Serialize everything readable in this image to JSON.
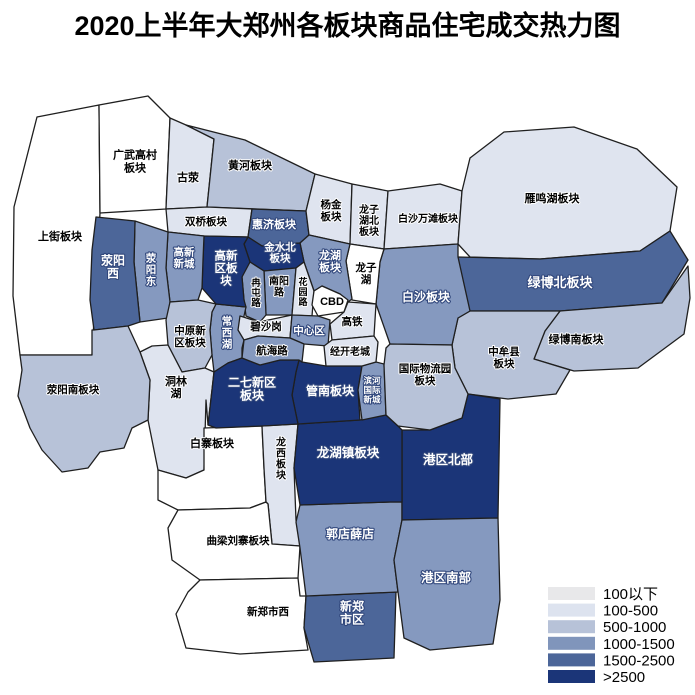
{
  "title": "2020上半年大郑州各板块商品住宅成交热力图",
  "legend": {
    "x": 548,
    "y": 587,
    "swatch_w": 47,
    "swatch_h": 13,
    "row_h": 16.6,
    "label_gap": 8,
    "items": [
      {
        "label": "100以下",
        "color": "#e8e8ea"
      },
      {
        "label": "100-500",
        "color": "#dde3ef"
      },
      {
        "label": "500-1000",
        "color": "#b7c2d8"
      },
      {
        "label": "1000-1500",
        "color": "#8095bb"
      },
      {
        "label": "1500-2500",
        "color": "#4c6699"
      },
      {
        "label": ">2500",
        "color": "#1b3578"
      }
    ]
  },
  "map": {
    "border_color": "#1f1f1f",
    "tier_fills": [
      "#ffffff",
      "#dfe4ef",
      "#b7c2d8",
      "#8599bf",
      "#4c6699",
      "#1b3578"
    ],
    "regions": [
      {
        "id": "shangjie",
        "label": "上街板块",
        "tier": 1,
        "range": "100以下",
        "c": "d",
        "x": 60,
        "y": 237,
        "fs": 11,
        "pts": "37,117 99,105 100,213 92,355 20,355 13,296 14,207"
      },
      {
        "id": "guangwu-gaocun",
        "label": "广武高村板块",
        "lines": [
          "广武高村",
          "板块"
        ],
        "tier": 1,
        "range": "100以下",
        "c": "d",
        "x": 135,
        "y": 162,
        "fs": 11,
        "lh": 13,
        "pts": "99,105 148,96 170,118 166,209 100,213"
      },
      {
        "id": "guying",
        "label": "古荥",
        "tier": 2,
        "range": "100-500",
        "c": "d",
        "x": 188,
        "y": 178,
        "fs": 11,
        "pts": "170,118 186,125 214,139 207,207 166,209"
      },
      {
        "id": "huanghe",
        "label": "黄河板块",
        "tier": 3,
        "range": "500-1000",
        "c": "d",
        "x": 250,
        "y": 166,
        "fs": 11,
        "pts": "186,125 245,140 315,174 306,211 207,207 214,139"
      },
      {
        "id": "shuangqiao",
        "label": "双桥板块",
        "tier": 2,
        "range": "100-500",
        "c": "d",
        "x": 206,
        "y": 222,
        "fs": 10.5,
        "pts": "166,209 207,207 252,209 248,237 204,236 168,232"
      },
      {
        "id": "huiji",
        "label": "惠济板块",
        "tier": 5,
        "range": "1500-2500",
        "c": "l",
        "x": 274,
        "y": 225,
        "fs": 11,
        "pts": "252,209 306,211 309,235 300,243 262,246 248,237"
      },
      {
        "id": "yangjin",
        "label": "杨金板块",
        "lines": [
          "杨金",
          "板块"
        ],
        "tier": 2,
        "range": "100-500",
        "c": "d",
        "x": 331,
        "y": 211,
        "fs": 10.5,
        "lh": 12,
        "pts": "306,211 315,174 352,184 350,244 309,235"
      },
      {
        "id": "longzihu-bei",
        "label": "龙子湖北板块",
        "lines": [
          "龙子",
          "湖北",
          "板块"
        ],
        "tier": 2,
        "range": "100-500",
        "c": "d",
        "x": 369,
        "y": 221,
        "fs": 10,
        "lh": 11,
        "pts": "352,184 388,191 384,249 350,244"
      },
      {
        "id": "baisha-wantan",
        "label": "白沙万滩板块",
        "tier": 2,
        "range": "100-500",
        "c": "d",
        "x": 428,
        "y": 219,
        "fs": 10,
        "pts": "388,191 440,184 462,191 458,244 384,249"
      },
      {
        "id": "yanminghu",
        "label": "雁鸣湖板块",
        "tier": 2,
        "range": "100-500",
        "c": "d",
        "x": 552,
        "y": 199,
        "fs": 11,
        "pts": "462,191 470,158 504,132 574,127 637,149 677,187 670,231 640,251 540,259 470,257 458,244"
      },
      {
        "id": "lvbo-bei",
        "label": "绿博北板块",
        "tier": 5,
        "range": "1500-2500",
        "c": "l",
        "x": 560,
        "y": 282,
        "fs": 13,
        "pts": "458,257 540,259 640,251 670,231 688,260 662,303 560,311 470,311 458,295"
      },
      {
        "id": "lvbo-nan",
        "label": "绿博南板块",
        "tier": 3,
        "range": "500-1000",
        "c": "d",
        "x": 576,
        "y": 340,
        "fs": 11,
        "pts": "560,311 662,303 688,266 690,298 684,334 638,368 574,371 534,359 545,331"
      },
      {
        "id": "zhongmou",
        "label": "中牟县板块",
        "lines": [
          "中牟县",
          "板块"
        ],
        "tier": 3,
        "range": "500-1000",
        "c": "d",
        "x": 504,
        "y": 358,
        "fs": 10.5,
        "lh": 12,
        "pts": "458,318 470,311 560,311 545,331 534,359 570,370 556,394 508,399 468,394 455,368 452,345"
      },
      {
        "id": "baisha",
        "label": "白沙板块",
        "tier": 4,
        "range": "1000-1500",
        "c": "l",
        "x": 426,
        "y": 297,
        "fs": 12,
        "pts": "384,249 458,244 458,257 470,311 458,318 452,345 390,344 376,304 380,262"
      },
      {
        "id": "longzihu",
        "label": "龙子湖",
        "lines": [
          "龙子",
          "湖"
        ],
        "tier": 1,
        "range": "100以下",
        "c": "d",
        "x": 366,
        "y": 274,
        "fs": 10.5,
        "lh": 12,
        "pts": "350,244 384,249 380,262 376,304 352,300 346,261"
      },
      {
        "id": "longhu",
        "label": "龙湖板块",
        "lines": [
          "龙湖",
          "板块"
        ],
        "tier": 4,
        "range": "1000-1500",
        "c": "l",
        "x": 330,
        "y": 262,
        "fs": 11,
        "lh": 12,
        "pts": "309,235 350,244 346,261 352,299 348,302 340,294 322,286 314,291 304,262 300,243"
      },
      {
        "id": "jinshui-bei",
        "label": "金水北板块",
        "lines": [
          "金水北",
          "板块"
        ],
        "tier": 6,
        "range": ">2500",
        "c": "l",
        "x": 280,
        "y": 253,
        "fs": 10.5,
        "lh": 11,
        "pts": "248,237 262,246 300,243 304,262 296,268 264,271 250,262 244,244"
      },
      {
        "id": "nanyang-lu",
        "label": "南阳路",
        "lines": [
          "南阳",
          "路"
        ],
        "tier": 4,
        "range": "1000-1500",
        "c": "d",
        "x": 279,
        "y": 287,
        "fs": 10,
        "lh": 11,
        "pts": "264,271 296,268 292,315 266,315"
      },
      {
        "id": "rantun-lu",
        "label": "冉屯路",
        "lines": [
          "冉",
          "屯",
          "路"
        ],
        "tier": 4,
        "range": "1000-1500",
        "c": "d",
        "x": 256,
        "y": 293,
        "fs": 9.5,
        "lh": 10,
        "pts": "250,262 264,271 266,315 260,322 246,316 244,300 242,277 244,268"
      },
      {
        "id": "huayuan-lu",
        "label": "花园路",
        "lines": [
          "花",
          "园",
          "路"
        ],
        "tier": 2,
        "range": "100-500",
        "c": "d",
        "x": 303,
        "y": 292,
        "fs": 9,
        "lh": 10,
        "pts": "296,268 304,262 314,291 312,316 292,315"
      },
      {
        "id": "cbd",
        "label": "CBD",
        "tier": 1,
        "range": "100以下",
        "c": "d",
        "x": 332,
        "y": 302,
        "fs": 11,
        "pts": "314,291 322,286 340,294 348,300 344,312 318,316 312,305"
      },
      {
        "id": "changxihu",
        "label": "常西湖",
        "lines": [
          "常",
          "西",
          "湖"
        ],
        "tier": 4,
        "range": "1000-1500",
        "c": "l",
        "x": 227,
        "y": 333,
        "fs": 10.5,
        "lh": 11.5,
        "pts": "216,304 246,307 244,316 244,340 242,348 242,358 228,363 214,372 212,355 210,330 212,312"
      },
      {
        "id": "gaoxin-qu",
        "label": "高新区板块",
        "lines": [
          "高新",
          "区板",
          "块"
        ],
        "tier": 6,
        "range": ">2500",
        "c": "l",
        "x": 226,
        "y": 269,
        "fs": 11.5,
        "lh": 12.5,
        "pts": "204,236 248,237 244,244 250,262 242,277 244,300 246,307 216,304 202,288 203,260"
      },
      {
        "id": "gaoxin-xincheng",
        "label": "高新新城",
        "lines": [
          "高新",
          "新城"
        ],
        "tier": 4,
        "range": "1000-1500",
        "c": "l",
        "x": 184,
        "y": 258,
        "fs": 10.5,
        "lh": 11.5,
        "pts": "168,232 204,236 203,260 202,288 198,300 170,302 166,268"
      },
      {
        "id": "xingyang-dong",
        "label": "荥阳东",
        "lines": [
          "荥",
          "阳",
          "东"
        ],
        "tier": 4,
        "range": "1000-1500",
        "c": "l",
        "x": 151,
        "y": 270,
        "fs": 10.5,
        "lh": 11.5,
        "pts": "135,221 168,232 166,268 170,302 168,318 140,322 134,262"
      },
      {
        "id": "xingyang-xi",
        "label": "荥阳西",
        "lines": [
          "荥阳",
          "西"
        ],
        "tier": 5,
        "range": "1500-2500",
        "c": "l",
        "x": 113,
        "y": 267,
        "fs": 12,
        "lh": 13,
        "pts": "96,217 135,221 134,262 140,322 128,326 94,330 90,300 92,250"
      },
      {
        "id": "zhongyuan-xinqu",
        "label": "中原新区板块",
        "lines": [
          "中原新",
          "区板块"
        ],
        "tier": 3,
        "range": "500-1000",
        "c": "d",
        "x": 190,
        "y": 337,
        "fs": 10.5,
        "lh": 12,
        "pts": "170,302 198,300 216,304 212,312 210,330 212,355 205,368 182,372 168,345 166,320"
      },
      {
        "id": "donglinhu",
        "label": "洞林湖",
        "lines": [
          "洞林",
          "湖"
        ],
        "tier": 2,
        "range": "100-500",
        "c": "d",
        "x": 176,
        "y": 388,
        "fs": 11,
        "lh": 12,
        "pts": "140,352 152,346 168,345 182,372 205,368 214,372 212,390 208,425 206,400 204,470 186,478 158,470 148,420 150,380"
      },
      {
        "id": "xingyang-nan",
        "label": "荥阳南板块",
        "tier": 3,
        "range": "500-1000",
        "c": "d",
        "x": 73,
        "y": 390,
        "fs": 10.5,
        "pts": "20,355 92,355 92,330 94,330 128,326 140,352 150,380 148,420 132,428 124,448 100,452 88,468 62,472 42,450 30,428 18,396 22,370"
      },
      {
        "id": "baizhai",
        "label": "白寨板块",
        "tier": 1,
        "range": "100以下",
        "c": "d",
        "x": 212,
        "y": 444,
        "fs": 11,
        "pts": "204,428 262,426 264,468 266,502 250,508 178,510 158,500 158,470 186,478 204,470"
      },
      {
        "id": "longxi",
        "label": "龙西板块",
        "lines": [
          "龙",
          "西",
          "板",
          "块"
        ],
        "tier": 2,
        "range": "100-500",
        "c": "d",
        "x": 281,
        "y": 459,
        "fs": 10,
        "lh": 11,
        "pts": "262,426 298,424 294,468 296,520 300,546 272,544 268,504 266,502 264,468"
      },
      {
        "id": "quliang-liuzhai",
        "label": "曲梁刘寨板块",
        "tier": 1,
        "range": "100以下",
        "c": "d",
        "x": 238,
        "y": 541,
        "fs": 10.5,
        "pts": "168,528 178,510 250,508 266,502 268,504 272,544 300,546 298,578 200,580 172,560"
      },
      {
        "id": "xinzheng-west",
        "label": "新郑市西",
        "tier": 1,
        "range": "100以下",
        "c": "d",
        "x": 268,
        "y": 612,
        "fs": 10.5,
        "pts": "200,580 298,578 300,596 306,596 304,628 308,650 240,654 186,648 176,614 188,592"
      },
      {
        "id": "xinzheng-city",
        "label": "新郑市区",
        "lines": [
          "新郑",
          "市区"
        ],
        "tier": 5,
        "range": "1500-2500",
        "c": "l",
        "x": 352,
        "y": 613,
        "fs": 12,
        "lh": 13,
        "pts": "306,596 396,592 394,658 314,662 304,628"
      },
      {
        "id": "guodian-xuedian",
        "label": "郭店薛店",
        "tier": 4,
        "range": "1000-1500",
        "c": "l",
        "x": 350,
        "y": 534,
        "fs": 12,
        "pts": "300,505 390,502 402,502 402,520 398,540 394,560 398,592 306,596 300,548 296,522"
      },
      {
        "id": "gangqu-bei",
        "label": "港区北部",
        "tier": 6,
        "range": ">2500",
        "c": "l",
        "x": 448,
        "y": 460,
        "fs": 12.5,
        "pts": "402,430 430,430 462,418 468,394 500,399 498,518 402,520"
      },
      {
        "id": "gangqu-nan",
        "label": "港区南部",
        "tier": 4,
        "range": "1000-1500",
        "c": "l",
        "x": 446,
        "y": 578,
        "fs": 12.5,
        "pts": "402,520 498,518 500,600 493,644 430,650 404,638 398,592 394,560 398,540"
      },
      {
        "id": "longhu-zhen",
        "label": "龙湖镇板块",
        "tier": 6,
        "range": ">2500",
        "c": "l",
        "x": 348,
        "y": 453,
        "fs": 12.5,
        "pts": "298,424 360,420 386,415 398,426 402,430 402,502 390,502 300,505 294,468"
      },
      {
        "id": "guannan",
        "label": "管南板块",
        "tier": 6,
        "range": ">2500",
        "c": "l",
        "x": 330,
        "y": 391,
        "fs": 12,
        "pts": "299,360 302,362 326,366 362,366 358,390 360,420 298,424 292,395 296,372"
      },
      {
        "id": "binhe",
        "label": "滨河国际新城",
        "lines": [
          "滨河",
          "国际",
          "新城"
        ],
        "tier": 4,
        "range": "1000-1500",
        "c": "l",
        "x": 372,
        "y": 390,
        "fs": 8.5,
        "lh": 9.5,
        "pts": "362,366 376,362 384,364 386,415 362,420 358,390"
      },
      {
        "id": "guoji-wuliu",
        "label": "国际物流园板块",
        "lines": [
          "国际物流园",
          "板块"
        ],
        "tier": 3,
        "range": "500-1000",
        "c": "d",
        "x": 425,
        "y": 375,
        "fs": 10.5,
        "lh": 12,
        "pts": "386,348 390,344 452,345 455,368 468,394 462,418 430,430 398,426 386,415 384,365"
      },
      {
        "id": "erqi-xinqu",
        "label": "二七新区板块",
        "lines": [
          "二七新区",
          "板块"
        ],
        "tier": 6,
        "range": ">2500",
        "c": "l",
        "x": 252,
        "y": 389,
        "fs": 12,
        "lh": 13,
        "pts": "214,372 228,363 242,358 260,365 280,360 299,360 296,372 292,395 298,424 262,426 216,428 208,425 212,390"
      },
      {
        "id": "bisha-gang",
        "label": "碧沙岗",
        "tier": 2,
        "range": "100-500",
        "c": "d",
        "x": 266,
        "y": 327,
        "fs": 10.5,
        "pts": "240,316 259,322 292,315 290,338 258,336 244,340 238,330"
      },
      {
        "id": "zhongxin-qu",
        "label": "中心区",
        "tier": 4,
        "range": "1000-1500",
        "c": "l",
        "x": 309,
        "y": 331,
        "fs": 10.5,
        "pts": "292,315 318,316 330,320 328,346 304,344 290,338"
      },
      {
        "id": "gaotie",
        "label": "高铁",
        "tier": 2,
        "range": "100-500",
        "c": "d",
        "x": 352,
        "y": 322,
        "fs": 10.5,
        "pts": "344,312 348,302 376,304 374,336 332,340 330,324"
      },
      {
        "id": "jingkai-laocheng",
        "label": "经开老城",
        "tier": 2,
        "range": "100-500",
        "c": "d",
        "x": 350,
        "y": 352,
        "fs": 10,
        "pts": "332,340 374,336 378,342 376,362 362,366 326,366 324,346"
      },
      {
        "id": "hanghai-lu",
        "label": "航海路",
        "tier": 4,
        "range": "1000-1500",
        "c": "d",
        "x": 272,
        "y": 351,
        "fs": 10.5,
        "pts": "244,340 258,336 290,338 304,344 302,362 299,360 280,360 260,365 242,358"
      }
    ]
  }
}
